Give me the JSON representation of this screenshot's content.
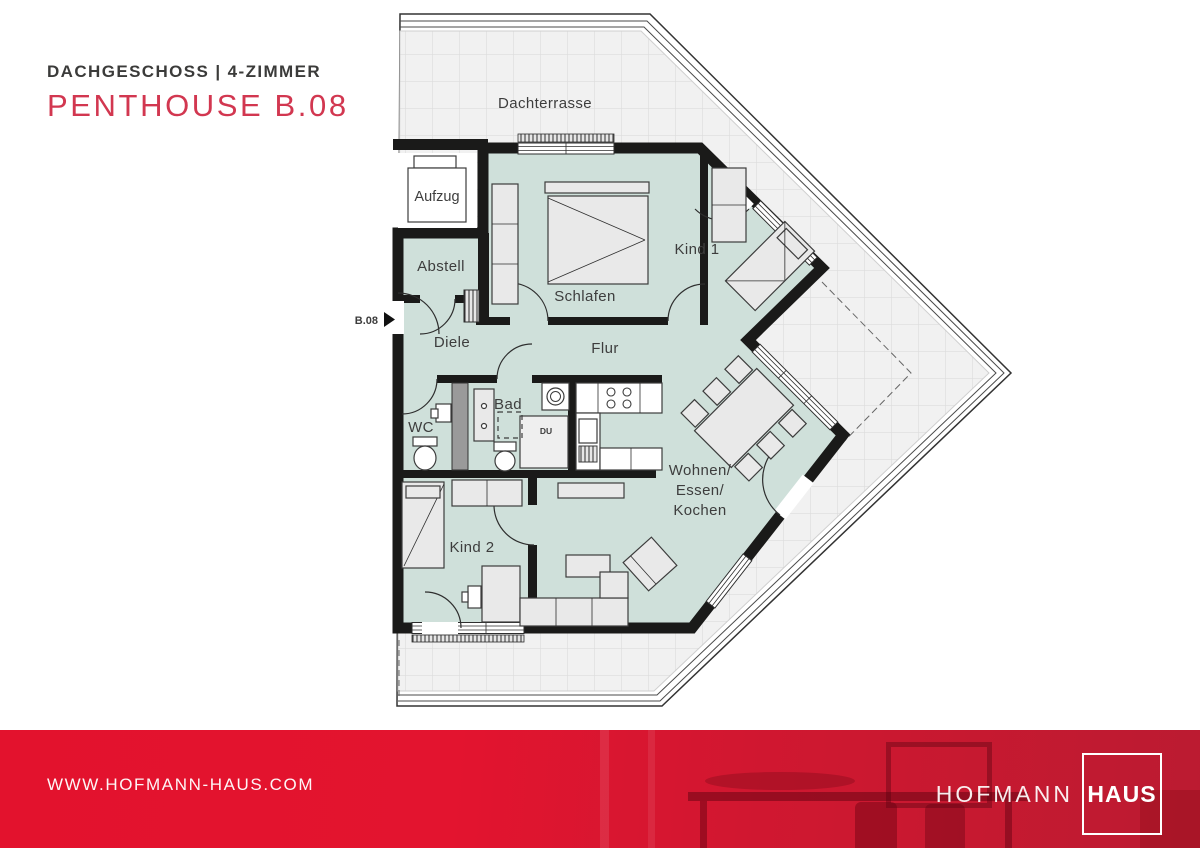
{
  "header": {
    "subtitle": "DACHGESCHOSS | 4-ZIMMER",
    "title": "PENTHOUSE B.08"
  },
  "floorplan": {
    "unit_label": "B.08",
    "labels": {
      "dachterrasse": "Dachterrasse",
      "aufzug": "Aufzug",
      "abstell": "Abstell",
      "schlafen": "Schlafen",
      "kind1": "Kind 1",
      "diele": "Diele",
      "flur": "Flur",
      "wc": "WC",
      "bad": "Bad",
      "dusche": "DU",
      "kind2": "Kind 2",
      "wohnen_line1": "Wohnen/",
      "wohnen_line2": "Essen/",
      "wohnen_line3": "Kochen"
    }
  },
  "footer": {
    "website": "WWW.HOFMANN-HAUS.COM",
    "logo_part1": "HOFMANN",
    "logo_part2": "HAUS"
  },
  "colors": {
    "brand_red": "#E3122D",
    "title_red": "#D23750",
    "room_fill": "#CFE0DA",
    "wall": "#1A1A19",
    "terrace_tile": "#F1F1F1"
  }
}
